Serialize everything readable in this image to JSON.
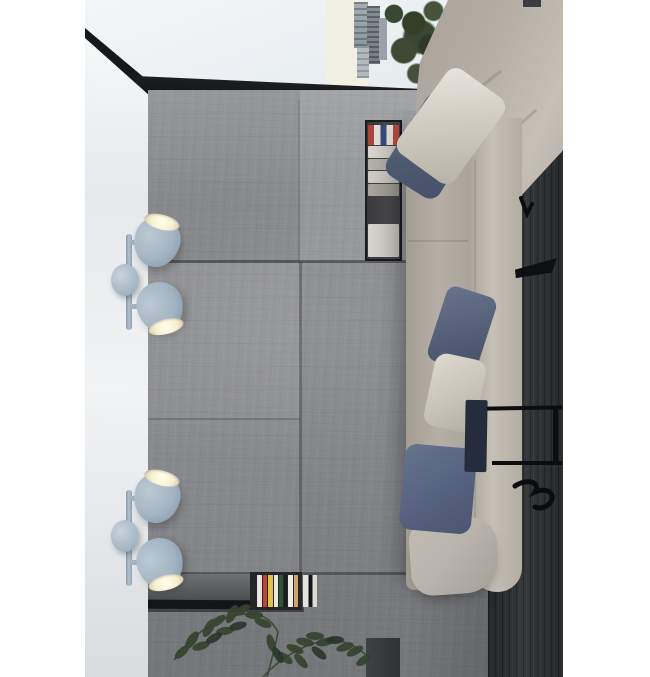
{
  "scene": {
    "description": "Top-down interior render: concrete floor room with corner sofa, pillows, two double-head wall spotlights on a white wall, book niches, side table and a green plant branch; city-view window at top"
  },
  "palette": {
    "white": "#ffffff",
    "ceiling": "#edf1f4",
    "window_sky": "#f2efe4",
    "trim_black": "#17181b",
    "side_wall_light": "#f2f3f5",
    "side_wall_dark": "#d9dbde",
    "concrete_base": "#8f9093",
    "concrete_dark": "#7c7e81",
    "seam": "#2a2b2d",
    "sofa_base": "#b6afa6",
    "sofa_light": "#c6c0b7",
    "pillow_white_light": "#e9e5dd",
    "pillow_white_dark": "#b7b2a6",
    "pillow_blue_light": "#6b7890",
    "pillow_blue_dark": "#46516b",
    "cushion_grey": "#b9b5ad",
    "tray_navy": "#252d3c",
    "charcoal_light": "#35383b",
    "charcoal_dark": "#24272a",
    "metal_black": "#0c0d0f",
    "lamp_shade_light": "#bcc9d4",
    "lamp_shade_base": "#a3b4c2",
    "lamp_shade_dark": "#8499ab",
    "lamp_interior": "#f6efd2",
    "lamp_interior_bright": "#fffbe4",
    "niche_bg": "#46464a",
    "niche_border": "#1a1b1d",
    "ledge_black": "#131417",
    "tree_green": "#3a4733",
    "plant_green": "#36432f",
    "plant_green_dark": "#2a352a"
  },
  "books": {
    "top_niche_stack": [
      {
        "kind": "flag-cover-book",
        "h": 20,
        "colors": [
          "#a8453e",
          "#dfdcd6",
          "#3a4a7e",
          "#dfdcd6",
          "#b04a42"
        ]
      },
      {
        "kind": "white-book",
        "h": 12,
        "colors": [
          "#d9d6cf"
        ]
      },
      {
        "kind": "grey-book",
        "h": 11,
        "colors": [
          "#b5b2ab"
        ]
      },
      {
        "kind": "light-book",
        "h": 12,
        "colors": [
          "#cfccc5"
        ]
      },
      {
        "kind": "dark-book",
        "h": 12,
        "colors": [
          "#a9a59d"
        ]
      },
      {
        "kind": "gap",
        "h": 26,
        "colors": []
      },
      {
        "kind": "white-tall-book",
        "h": 33,
        "colors": [
          "#d8d5cd"
        ]
      }
    ],
    "bottom_spines": [
      {
        "c": "#232426",
        "w": 4
      },
      {
        "c": "#e9e6df",
        "w": 5
      },
      {
        "c": "#c2413a",
        "w": 4
      },
      {
        "c": "#e2c244",
        "w": 5
      },
      {
        "c": "#ece9e2",
        "w": 4
      },
      {
        "c": "#2f5237",
        "w": 4
      },
      {
        "c": "#1b1c1e",
        "w": 3
      },
      {
        "c": "#efece5",
        "w": 5
      },
      {
        "c": "#c9a86a",
        "w": 4
      },
      {
        "c": "#26272a",
        "w": 3
      },
      {
        "c": "#e6e3dc",
        "w": 5
      },
      {
        "c": "#141518",
        "w": 3
      },
      {
        "c": "#dedbd4",
        "w": 4
      }
    ]
  }
}
